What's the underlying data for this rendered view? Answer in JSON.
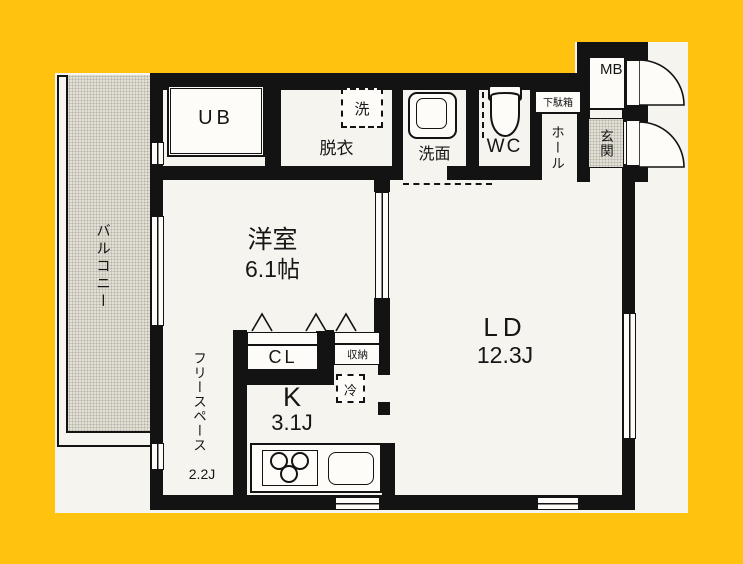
{
  "colors": {
    "background": "#ffc20e",
    "paper": "#f6f4ee",
    "wall": "#131313",
    "texture": "#e2dfd6"
  },
  "plan": {
    "balcony": "バルコニー",
    "unit_bath": "UB",
    "dressing_room": "脱衣",
    "washing_machine": "洗",
    "vanity": "洗面",
    "toilet": "WC",
    "shoe_cabinet": "下駄箱",
    "hall": "ホール",
    "meter_box": "MB",
    "entrance": "玄関",
    "western_room": {
      "name": "洋室",
      "size": "6.1帖"
    },
    "living_dining": {
      "name": "LD",
      "size": "12.3J"
    },
    "closet": "CL",
    "storage": "収納",
    "refrigerator": "冷",
    "kitchen": {
      "name": "K",
      "size": "3.1J"
    },
    "free_space": {
      "name": "フリースペース",
      "size": "2.2J"
    }
  }
}
